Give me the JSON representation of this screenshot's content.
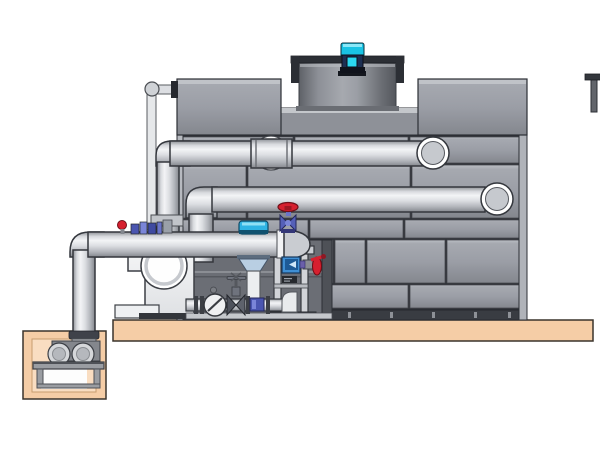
{
  "scene": {
    "type": "technical-illustration",
    "subject": "cooling-tower-with-pump-skid-and-pit-pump",
    "text_visible": false
  },
  "components": {
    "cooling_tower": "paneled cooling tower casing",
    "fan_shroud": "cylindrical fan shroud on tower top",
    "fan_motor": "cyan fan motor",
    "vent_stub": "small dark stub at top right",
    "upper_inlet_pipe": "upper horizontal pipe with ringed elbow into tower",
    "middle_return_pipe": "middle horizontal pipe with ringed elbow into tower",
    "discharge_header": "main horizontal pipe with dome end cap",
    "overflow_pipe": "thin vertical pipe with flange at tower top left",
    "riser_pipe": "vertical riser from header to upper pipe",
    "globe_valve_red": "red handwheel globe valve on header cap",
    "mini_ball_valve_red": "small red handle valve on header",
    "injection_fittings_blue": "blue fittings cluster on header",
    "control_valve_cyan": "cyan actuated control valve with cone body",
    "check_valve": "wafer check valve on low run",
    "gate_valve": "small gate valve with cross handle",
    "blue_tee": "blue tee fitting under control valve",
    "flow_meter_blue": "blue meter box in support frame",
    "butterfly_valve_red": "red lever butterfly valve at tower wall",
    "support_frame": "equipment support frame",
    "circulation_pump": "white end-suction pump with circular inlet",
    "concrete_slab": "tan equipment pad",
    "sump_pit": "below-grade tan pit",
    "pit_pump": "small pump set on stand inside pit"
  },
  "colors": {
    "background": "#ffffff",
    "slab": "#f5cda6",
    "pit-inner": "#f9ddc1",
    "tower-panel": "#9b9ea6",
    "tower-outline": "#2c2f35",
    "pipe-light": "#f3f4f6",
    "pipe-shadow": "#84878d",
    "valve-red": "#d6202f",
    "valve-blue": "#5560b8",
    "actuator-cyan": "#2fb4e4",
    "meter-blue": "#3f8fd4",
    "motor-cyan": "#19c3e4",
    "motor-navy": "#1d2f52",
    "skid-dark": "#6b6e75",
    "pump-white": "#eef0f2",
    "rail-dark": "#33363b"
  }
}
